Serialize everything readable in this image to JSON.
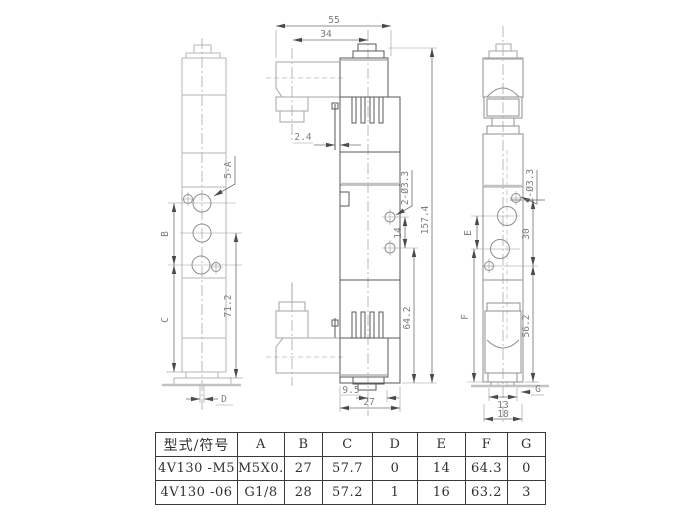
{
  "colors": {
    "background": "#ffffff",
    "line_dark": "#5a5a5a",
    "line_light": "#b4b4b4",
    "dim_line": "#6f6f6f",
    "dim_text": "#7d7d7d",
    "table_border": "#3a3a3a",
    "table_text": "#303030"
  },
  "views": {
    "left": {
      "labels": {
        "port_note": "5-A",
        "dim_b": "B",
        "dim_c": "C",
        "dim_71": "71.2",
        "dim_d": "D"
      }
    },
    "front": {
      "labels": {
        "dim_55": "55",
        "dim_34": "34",
        "dim_2_4": "2.4",
        "hole_note": "2-Ø3.3",
        "dim_14": "14",
        "dim_157": "157.4",
        "dim_64": "64.2",
        "dim_9_5": "9.5",
        "dim_27": "27"
      }
    },
    "right": {
      "labels": {
        "hole_note": "2-Ø3.3",
        "dim_e": "E",
        "dim_30": "30",
        "dim_f": "F",
        "dim_56": "56.2",
        "dim_g": "G",
        "dim_13": "13",
        "dim_18": "18"
      }
    }
  },
  "table": {
    "headers": [
      "型式/符号",
      "A",
      "B",
      "C",
      "D",
      "E",
      "F",
      "G"
    ],
    "rows": [
      [
        "4V130 -M5",
        "M5X0.8",
        "27",
        "57.7",
        "0",
        "14",
        "64.3",
        "0"
      ],
      [
        "4V130 -06",
        "G1/8",
        "28",
        "57.2",
        "1",
        "16",
        "63.2",
        "3"
      ]
    ]
  }
}
